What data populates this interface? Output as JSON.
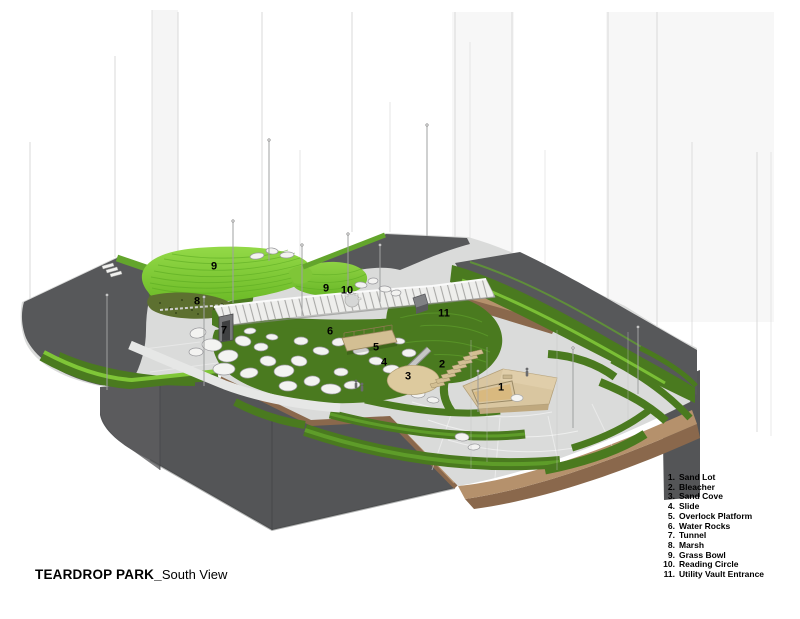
{
  "title": {
    "name": "TEARDROP PARK",
    "separator": "_",
    "view": "South View"
  },
  "legend": {
    "items": [
      {
        "num": "1.",
        "label": "Sand Lot"
      },
      {
        "num": "2.",
        "label": "Bleacher"
      },
      {
        "num": "3.",
        "label": "Sand Cove"
      },
      {
        "num": "4.",
        "label": "Slide"
      },
      {
        "num": "5.",
        "label": "Overlock Platform"
      },
      {
        "num": "6.",
        "label": "Water Rocks"
      },
      {
        "num": "7.",
        "label": "Tunnel"
      },
      {
        "num": "8.",
        "label": "Marsh"
      },
      {
        "num": "9.",
        "label": "Grass Bowl"
      },
      {
        "num": "10.",
        "label": "Reading Circle"
      },
      {
        "num": "11.",
        "label": "Utility Vault Entrance"
      }
    ]
  },
  "callouts": [
    {
      "n": "9",
      "x": 214,
      "y": 267
    },
    {
      "n": "8",
      "x": 197,
      "y": 302
    },
    {
      "n": "9",
      "x": 326,
      "y": 289
    },
    {
      "n": "10",
      "x": 347,
      "y": 291
    },
    {
      "n": "11",
      "x": 444,
      "y": 314
    },
    {
      "n": "7",
      "x": 224,
      "y": 331
    },
    {
      "n": "6",
      "x": 330,
      "y": 332
    },
    {
      "n": "5",
      "x": 376,
      "y": 348
    },
    {
      "n": "4",
      "x": 384,
      "y": 363
    },
    {
      "n": "3",
      "x": 408,
      "y": 377
    },
    {
      "n": "2",
      "x": 442,
      "y": 365
    },
    {
      "n": "1",
      "x": 501,
      "y": 388
    }
  ],
  "colors": {
    "grass_bright": "#7fc637",
    "grass_light": "#9ad84e",
    "grass_mid": "#63a52c",
    "grass_dark": "#4a7a1f",
    "marsh_olive": "#5d7030",
    "paving": "#dadbda",
    "paving_path": "#e6e7e6",
    "plaza_dark": "#57585a",
    "base_dark": "#545557",
    "soil_top": "#b5916c",
    "soil_side": "#8a684c",
    "sand": "#ddca9e",
    "sand_inner": "#d9b97f",
    "wood": "#d3bf93",
    "rock_fill": "#f3f3f1",
    "rock_stroke": "#97979b",
    "guide_line": "#d9d9d9",
    "label_text": "#000000"
  }
}
